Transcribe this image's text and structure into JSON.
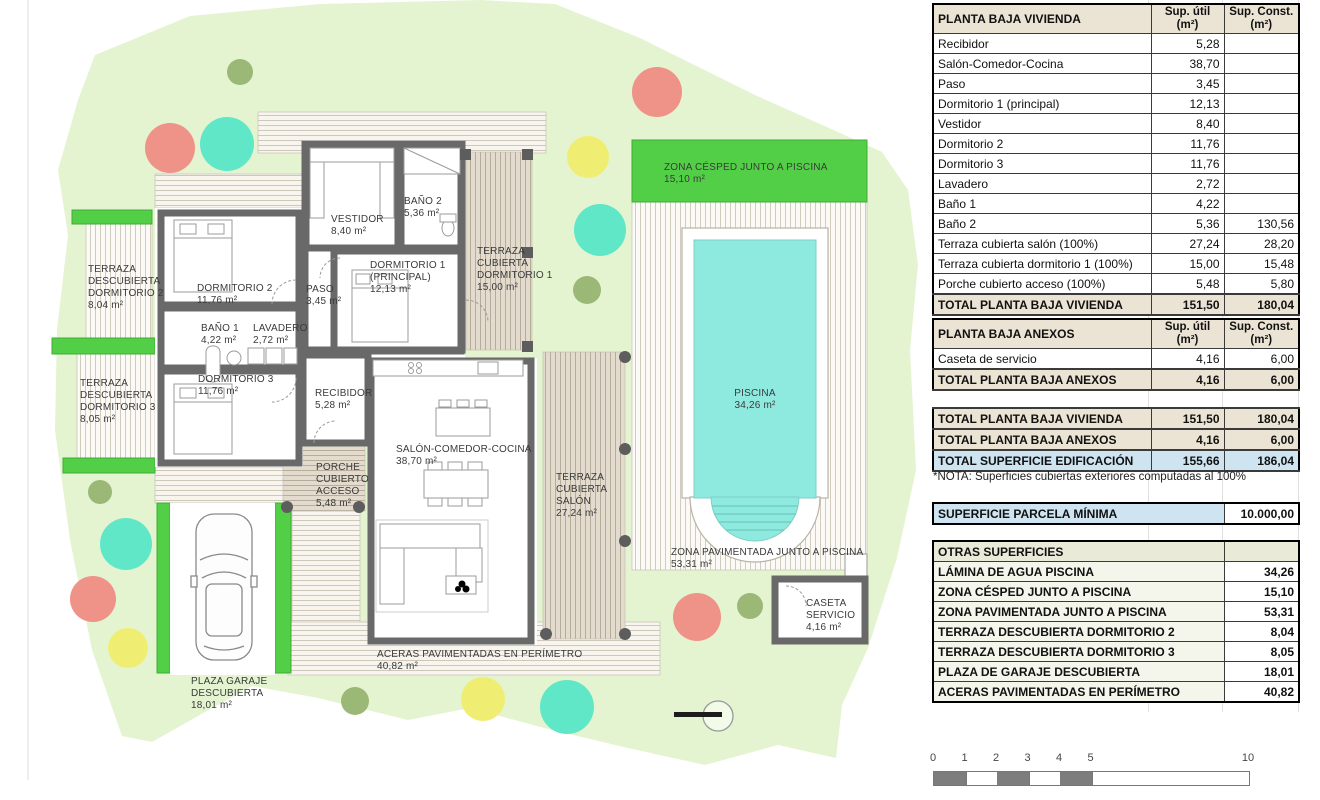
{
  "plan": {
    "labels": [
      {
        "id": "terraza-descubierta-dormitorio-2",
        "text": "TERRAZA\nDESCUBIERTA\nDORMITORIO 2\n8,04 m²"
      },
      {
        "id": "terraza-descubierta-dormitorio-3",
        "text": "TERRAZA\nDESCUBIERTA\nDORMITORIO 3\n8,05 m²"
      },
      {
        "id": "dormitorio-2",
        "text": "DORMITORIO 2\n11,76 m²"
      },
      {
        "id": "paso",
        "text": "PASO\n3,45 m²"
      },
      {
        "id": "vestidor",
        "text": "VESTIDOR\n8,40 m²"
      },
      {
        "id": "bano-2",
        "text": "BAÑO 2\n5,36 m²"
      },
      {
        "id": "dormitorio-1",
        "text": "DORMITORIO 1\n(PRINCIPAL)\n12,13 m²"
      },
      {
        "id": "terraza-cubierta-dormitorio-1",
        "text": "TERRAZA\nCUBIERTA\nDORMITORIO 1\n15,00 m²"
      },
      {
        "id": "bano-1",
        "text": "BAÑO 1\n4,22 m²"
      },
      {
        "id": "lavadero",
        "text": "LAVADERO\n2,72 m²"
      },
      {
        "id": "dormitorio-3",
        "text": "DORMITORIO 3\n11,76 m²"
      },
      {
        "id": "recibidor",
        "text": "RECIBIDOR\n5,28 m²"
      },
      {
        "id": "salon-comedor-cocina",
        "text": "SALÓN-COMEDOR-COCINA\n38,70 m²"
      },
      {
        "id": "terraza-cubierta-salon",
        "text": "TERRAZA\nCUBIERTA\nSALÓN\n27,24 m²"
      },
      {
        "id": "porche-cubierto-acceso",
        "text": "PORCHE\nCUBIERTO\nACCESO\n5,48 m²"
      },
      {
        "id": "zona-cesped",
        "text": "ZONA CÉSPED JUNTO A PISCINA\n15,10 m²"
      },
      {
        "id": "piscina",
        "text": "PISCINA\n34,26 m²"
      },
      {
        "id": "zona-pavimentada",
        "text": "ZONA PAVIMENTADA JUNTO A PISCINA\n53,31 m²"
      },
      {
        "id": "caseta-servicio",
        "text": "CASETA\nSERVICIO\n4,16 m²"
      },
      {
        "id": "aceras",
        "text": "ACERAS PAVIMENTADAS EN PERÍMETRO\n40,82 m²"
      },
      {
        "id": "plaza-garaje",
        "text": "PLAZA GARAJE\nDESCUBIERTA\n18,01 m²"
      }
    ],
    "colors": {
      "garden": "#e4f4d0",
      "hedge": "#53cf47",
      "water": "#8eeade",
      "wall": "#696969",
      "tree_teal": "#5fe7c7",
      "tree_yellow": "#f0ee72",
      "tree_salmon": "#ef9287",
      "tree_olive": "#9bb877",
      "table_beige": "#ebe4d4",
      "table_blue": "#cfe4f1",
      "otras_header": "#e9ead8"
    }
  },
  "tables": {
    "vivienda": {
      "title": "PLANTA BAJA VIVIENDA",
      "col_util": "Sup. útil\n(m²)",
      "col_const": "Sup. Const.\n(m²)",
      "rows": [
        {
          "label": "Recibidor",
          "util": "5,28",
          "cons": ""
        },
        {
          "label": "Salón-Comedor-Cocina",
          "util": "38,70",
          "cons": ""
        },
        {
          "label": "Paso",
          "util": "3,45",
          "cons": ""
        },
        {
          "label": "Dormitorio 1 (principal)",
          "util": "12,13",
          "cons": ""
        },
        {
          "label": "Vestidor",
          "util": "8,40",
          "cons": ""
        },
        {
          "label": "Dormitorio 2",
          "util": "11,76",
          "cons": ""
        },
        {
          "label": "Dormitorio 3",
          "util": "11,76",
          "cons": ""
        },
        {
          "label": "Lavadero",
          "util": "2,72",
          "cons": ""
        },
        {
          "label": "Baño 1",
          "util": "4,22",
          "cons": ""
        },
        {
          "label": "Baño 2",
          "util": "5,36",
          "cons": "130,56"
        },
        {
          "label": "Terraza cubierta salón (100%)",
          "util": "27,24",
          "cons": "28,20"
        },
        {
          "label": "Terraza cubierta dormitorio 1 (100%)",
          "util": "15,00",
          "cons": "15,48"
        },
        {
          "label": "Porche cubierto acceso (100%)",
          "util": "5,48",
          "cons": "5,80"
        },
        {
          "label": "TOTAL PLANTA BAJA VIVIENDA",
          "util": "151,50",
          "cons": "180,04",
          "cls": "total"
        }
      ]
    },
    "anexos": {
      "title": "PLANTA BAJA ANEXOS",
      "col_util": "Sup. útil\n(m²)",
      "col_const": "Sup. Const.\n(m²)",
      "rows": [
        {
          "label": "Caseta de servicio",
          "util": "4,16",
          "cons": "6,00"
        },
        {
          "label": "TOTAL PLANTA BAJA ANEXOS",
          "util": "4,16",
          "cons": "6,00",
          "cls": "total"
        }
      ]
    },
    "resumen": {
      "rows": [
        {
          "label": "TOTAL PLANTA BAJA VIVIENDA",
          "util": "151,50",
          "cons": "180,04",
          "cls": "total"
        },
        {
          "label": "TOTAL PLANTA BAJA ANEXOS",
          "util": "4,16",
          "cons": "6,00",
          "cls": "total"
        },
        {
          "label": "TOTAL SUPERFICIE EDIFICACIÓN",
          "util": "155,66",
          "cons": "186,04",
          "cls": "blue"
        }
      ]
    },
    "nota": "*NOTA: Superficies cubiertas exteriores computadas al 100%",
    "parcela": {
      "label": "SUPERFICIE PARCELA MÍNIMA",
      "value": "10.000,00"
    },
    "otras": {
      "title": "OTRAS SUPERFICIES",
      "rows": [
        {
          "label": "LÁMINA DE AGUA PISCINA",
          "value": "34,26"
        },
        {
          "label": "ZONA CÉSPED JUNTO A PISCINA",
          "value": "15,10"
        },
        {
          "label": "ZONA PAVIMENTADA JUNTO A PISCINA",
          "value": "53,31"
        },
        {
          "label": "TERRAZA DESCUBIERTA DORMITORIO 2",
          "value": "8,04"
        },
        {
          "label": "TERRAZA DESCUBIERTA DORMITORIO 3",
          "value": "8,05"
        },
        {
          "label": "PLAZA DE GARAJE DESCUBIERTA",
          "value": "18,01"
        },
        {
          "label": "ACERAS PAVIMENTADAS EN PERÍMETRO",
          "value": "40,82"
        }
      ]
    }
  },
  "scalebar": {
    "labels": [
      "0",
      "1",
      "2",
      "3",
      "4",
      "5",
      "10"
    ]
  }
}
